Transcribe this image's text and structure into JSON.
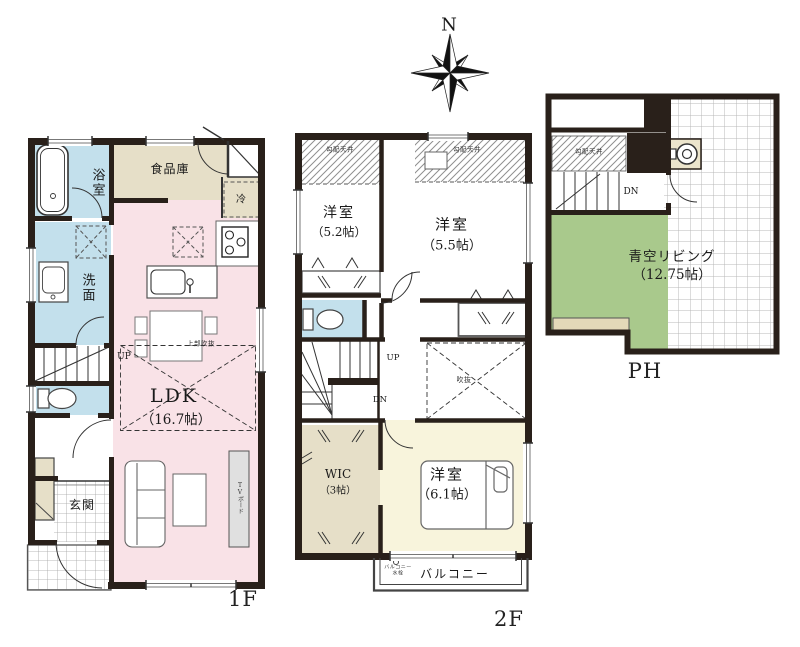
{
  "compass": {
    "north_label": "N"
  },
  "floor_1f": {
    "label": "1F",
    "bathroom": "浴室",
    "pantry": "食品庫",
    "fridge": "冷",
    "washroom": "洗面",
    "stairs_up": "UP",
    "void_above": "上部吹抜",
    "ldk_name": "LDK",
    "ldk_area": "（16.7帖）",
    "tv_board": "TVボード",
    "entrance": "玄関"
  },
  "floor_2f": {
    "label": "2F",
    "sloped_ceiling_left": "勾配天井",
    "sloped_ceiling_right": "勾配天井",
    "bedroom1_name": "洋室",
    "bedroom1_area": "（5.2帖）",
    "bedroom2_name": "洋室",
    "bedroom2_area": "（5.5帖）",
    "stairs_up": "UP",
    "stairs_down": "DN",
    "void": "吹抜",
    "wic_name": "WIC",
    "wic_area": "（3帖）",
    "bedroom3_name": "洋室",
    "bedroom3_area": "（6.1帖）",
    "balcony": "バルコニー",
    "balcony_faucet": "バルコニー水栓"
  },
  "floor_ph": {
    "label": "PH",
    "sloped_ceiling": "勾配天井",
    "stairs_down": "DN",
    "sky_living_name": "青空リビング",
    "sky_living_area": "（12.75帖）"
  },
  "colors": {
    "wall": "#29201a",
    "wet_room_blue": "#c3e0ec",
    "ldk_pink": "#f9e2e7",
    "storage_beige": "#e6dfc8",
    "bedroom_cream": "#f8f4dc",
    "roof_garden_green": "#a9c98c"
  }
}
